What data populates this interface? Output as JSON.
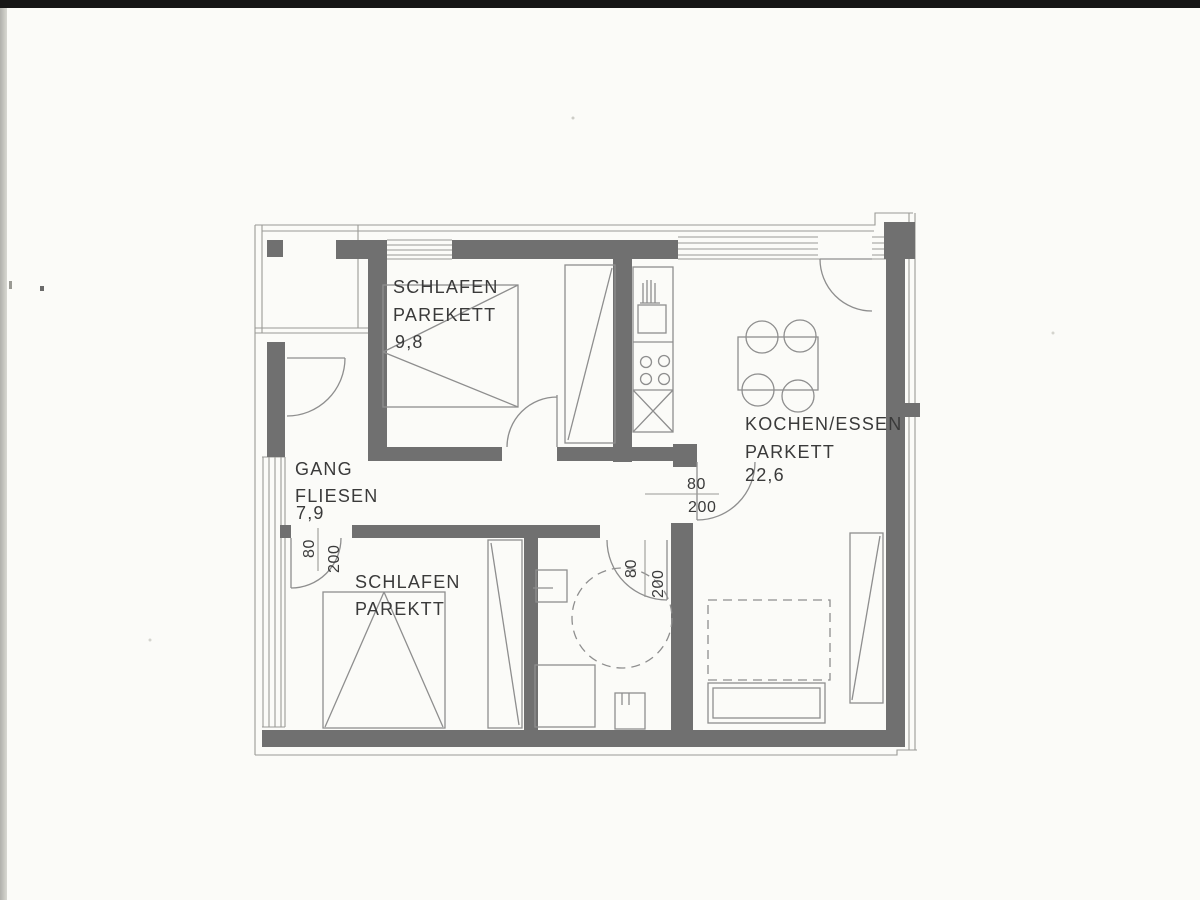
{
  "plan": {
    "rooms": {
      "bedroom_top": {
        "name": "SCHLAFEN",
        "floor": "PAREKETT",
        "area": "9,8"
      },
      "hallway": {
        "name": "GANG",
        "floor": "FLIESEN",
        "area": "7,9"
      },
      "kitchen_dining": {
        "name": "KOCHEN/ESSEN",
        "floor": "PARKETT",
        "area": "22,6"
      },
      "bedroom_bottom": {
        "name": "SCHLAFEN",
        "floor": "PAREKTT"
      }
    },
    "doors": {
      "kitchen": {
        "width": "80",
        "height": "200"
      },
      "bathroom": {
        "width": "80",
        "height": "200"
      },
      "bedroom_bottom": {
        "width": "80",
        "height": "200"
      }
    },
    "colors": {
      "wall": "#707070",
      "line": "#8e8e8e",
      "text": "#3a3a3a",
      "paper": "#fbfbf8",
      "scan_bar": "#161616"
    }
  }
}
